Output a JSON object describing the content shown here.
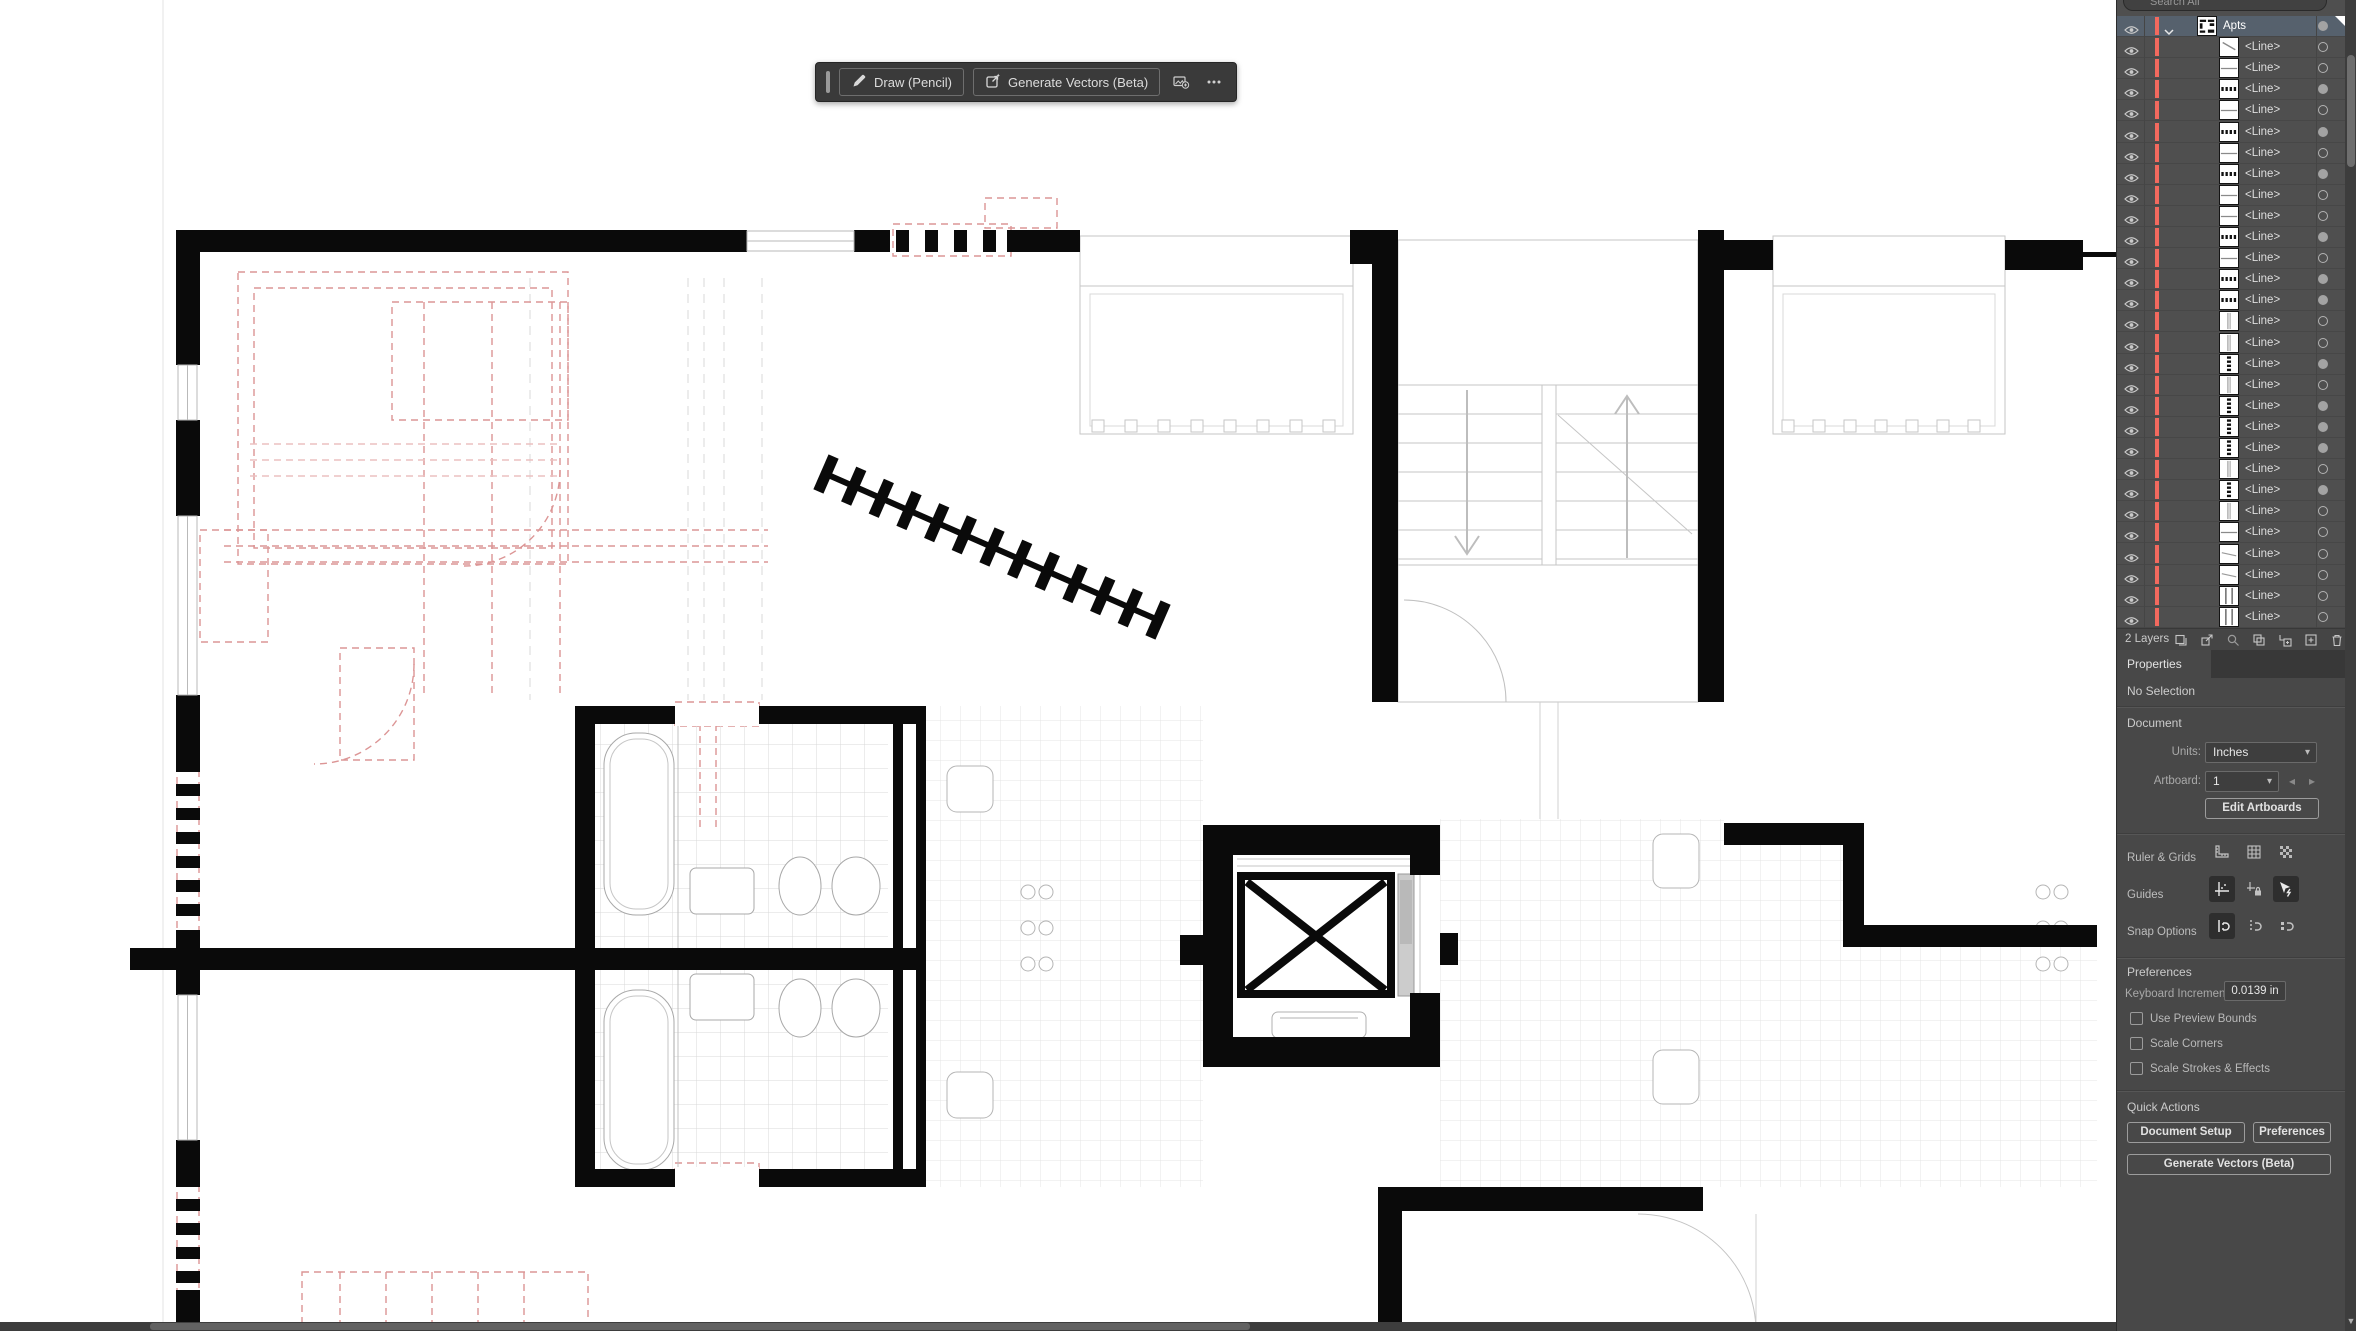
{
  "toolbar": {
    "draw_button": "Draw (Pencil)",
    "generate_button": "Generate Vectors (Beta)",
    "more_label": "•••",
    "icons": [
      "pencil-icon",
      "generate-vectors-icon",
      "add-image-icon",
      "more-options-icon"
    ]
  },
  "layers_panel": {
    "search_placeholder": "Search All",
    "status": "2 Layers",
    "footer_icons": [
      "collect-for-export-icon",
      "export-icon",
      "locate-object-icon",
      "make-clipping-mask-icon",
      "new-sublayer-icon",
      "new-layer-icon",
      "delete-icon"
    ],
    "rows": [
      {
        "label": "Apts",
        "thumb": "plan",
        "target": "filled",
        "selected": true,
        "expanded": true
      },
      {
        "label": "<Line>",
        "thumb": "diag-steep",
        "target": "empty"
      },
      {
        "label": "<Line>",
        "thumb": "h-line",
        "target": "empty"
      },
      {
        "label": "<Line>",
        "thumb": "h-dash",
        "target": "filled"
      },
      {
        "label": "<Line>",
        "thumb": "h-line",
        "target": "empty"
      },
      {
        "label": "<Line>",
        "thumb": "h-dash",
        "target": "filled"
      },
      {
        "label": "<Line>",
        "thumb": "h-line",
        "target": "empty"
      },
      {
        "label": "<Line>",
        "thumb": "h-dash",
        "target": "filled"
      },
      {
        "label": "<Line>",
        "thumb": "h-line",
        "target": "empty"
      },
      {
        "label": "<Line>",
        "thumb": "h-line",
        "target": "empty"
      },
      {
        "label": "<Line>",
        "thumb": "h-dash",
        "target": "filled"
      },
      {
        "label": "<Line>",
        "thumb": "h-line",
        "target": "empty"
      },
      {
        "label": "<Line>",
        "thumb": "h-dash",
        "target": "filled"
      },
      {
        "label": "<Line>",
        "thumb": "h-dash",
        "target": "filled"
      },
      {
        "label": "<Line>",
        "thumb": "v-line",
        "target": "empty"
      },
      {
        "label": "<Line>",
        "thumb": "v-line",
        "target": "empty"
      },
      {
        "label": "<Line>",
        "thumb": "v-dash",
        "target": "filled"
      },
      {
        "label": "<Line>",
        "thumb": "v-line",
        "target": "empty"
      },
      {
        "label": "<Line>",
        "thumb": "v-dash",
        "target": "filled"
      },
      {
        "label": "<Line>",
        "thumb": "v-dash",
        "target": "filled"
      },
      {
        "label": "<Line>",
        "thumb": "v-dash",
        "target": "filled"
      },
      {
        "label": "<Line>",
        "thumb": "v-line",
        "target": "empty"
      },
      {
        "label": "<Line>",
        "thumb": "v-dash",
        "target": "filled"
      },
      {
        "label": "<Line>",
        "thumb": "v-line",
        "target": "empty"
      },
      {
        "label": "<Line>",
        "thumb": "h-line",
        "target": "empty"
      },
      {
        "label": "<Line>",
        "thumb": "diag",
        "target": "empty"
      },
      {
        "label": "<Line>",
        "thumb": "diag",
        "target": "empty"
      },
      {
        "label": "<Line>",
        "thumb": "v-double",
        "target": "empty"
      },
      {
        "label": "<Line>",
        "thumb": "v-double",
        "target": "empty"
      }
    ]
  },
  "properties_panel": {
    "tab": "Properties",
    "selection_status": "No Selection",
    "document_section": {
      "title": "Document",
      "units_label": "Units:",
      "units_value": "Inches",
      "artboard_label": "Artboard:",
      "artboard_value": "1",
      "edit_artboards_button": "Edit Artboards"
    },
    "ruler_grids": {
      "label": "Ruler & Grids",
      "icons": [
        "ruler-icon",
        "grid-icon",
        "transparency-grid-icon"
      ]
    },
    "guides": {
      "label": "Guides",
      "icons": [
        "show-guides-icon",
        "lock-guides-icon",
        "smart-guides-icon"
      ]
    },
    "snap_options": {
      "label": "Snap Options",
      "icons": [
        "snap-to-point-icon",
        "snap-to-grid-icon",
        "snap-to-pixel-icon"
      ]
    },
    "preferences_section": {
      "title": "Preferences",
      "keyboard_increment_label": "Keyboard Increment:",
      "keyboard_increment_value": "0.0139 in",
      "checkboxes": [
        {
          "label": "Use Preview Bounds",
          "checked": false
        },
        {
          "label": "Scale Corners",
          "checked": false
        },
        {
          "label": "Scale Strokes & Effects",
          "checked": false
        }
      ]
    },
    "quick_actions": {
      "title": "Quick Actions",
      "buttons": [
        "Document Setup",
        "Preferences",
        "Generate Vectors (Beta)"
      ]
    }
  },
  "colors": {
    "panel_bg": "#4f4f4f",
    "selected_row": "#56616d",
    "layer_color_bar": "#f2695e",
    "walls": "#0a0a0a",
    "underlay_red": "#dc9595",
    "light_lines": "#c6c6c6"
  }
}
